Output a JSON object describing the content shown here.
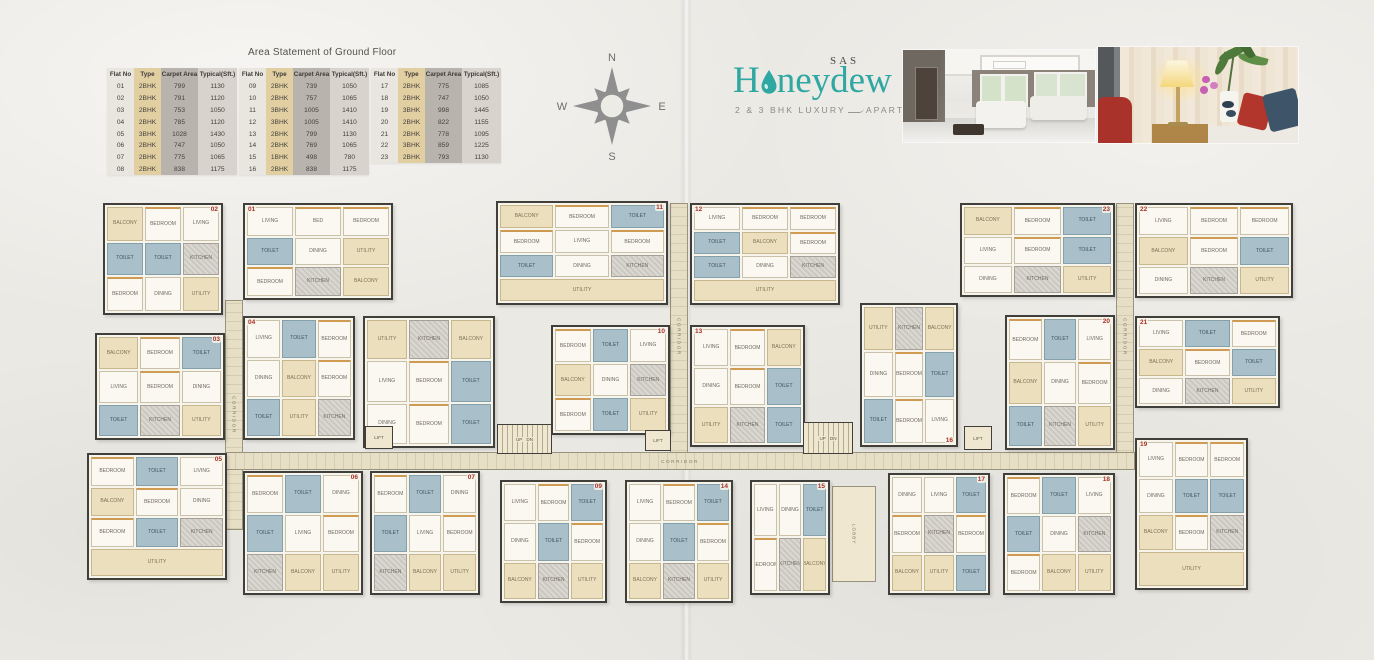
{
  "area_statement": {
    "title": "Area Statement of Ground Floor",
    "columns": [
      "Flat No",
      "Type",
      "Carpet Area",
      "Typical(Sft.)"
    ],
    "top": 68,
    "tables": [
      {
        "x": 107,
        "rows": [
          [
            "01",
            "2BHK",
            "799",
            "1130"
          ],
          [
            "02",
            "2BHK",
            "791",
            "1120"
          ],
          [
            "03",
            "2BHK",
            "753",
            "1050"
          ],
          [
            "04",
            "2BHK",
            "785",
            "1120"
          ],
          [
            "05",
            "3BHK",
            "1028",
            "1430"
          ],
          [
            "06",
            "2BHK",
            "747",
            "1050"
          ],
          [
            "07",
            "2BHK",
            "775",
            "1065"
          ],
          [
            "08",
            "2BHK",
            "838",
            "1175"
          ]
        ]
      },
      {
        "x": 239,
        "rows": [
          [
            "09",
            "2BHK",
            "739",
            "1050"
          ],
          [
            "10",
            "2BHK",
            "757",
            "1065"
          ],
          [
            "11",
            "3BHK",
            "1005",
            "1410"
          ],
          [
            "12",
            "3BHK",
            "1005",
            "1410"
          ],
          [
            "13",
            "2BHK",
            "799",
            "1130"
          ],
          [
            "14",
            "2BHK",
            "769",
            "1065"
          ],
          [
            "15",
            "1BHK",
            "498",
            "780"
          ],
          [
            "16",
            "2BHK",
            "838",
            "1175"
          ]
        ]
      },
      {
        "x": 371,
        "rows": [
          [
            "17",
            "2BHK",
            "775",
            "1085"
          ],
          [
            "18",
            "2BHK",
            "747",
            "1050"
          ],
          [
            "19",
            "3BHK",
            "998",
            "1445"
          ],
          [
            "20",
            "2BHK",
            "822",
            "1155"
          ],
          [
            "21",
            "2BHK",
            "778",
            "1095"
          ],
          [
            "22",
            "3BHK",
            "859",
            "1225"
          ],
          [
            "23",
            "2BHK",
            "793",
            "1130"
          ]
        ]
      }
    ]
  },
  "compass": {
    "n": "N",
    "s": "S",
    "e": "E",
    "w": "W"
  },
  "logo": {
    "pre": "SAS",
    "word_start": "H",
    "word_end": "neydew",
    "tagline_left": "2 & 3 BHK LUXURY",
    "tagline_right": "APARTMENTS"
  },
  "photos": {
    "left": "living-room-interior",
    "right": "lamp-and-cushions-decor"
  },
  "plan": {
    "corridor_label": "CORRIDOR",
    "lift_label": "LIFT",
    "lobby_label": "LOBBY",
    "up_label": "UP",
    "dn_label": "DN",
    "units": [
      {
        "no": "02",
        "x": 103,
        "y": 203,
        "w": 120,
        "h": 112,
        "tag": "tr",
        "rooms": [
          "BALCONY",
          "BEDROOM",
          "LIVING",
          "TOILET",
          "TOILET",
          "KITCHEN",
          "BEDROOM",
          "DINING",
          "UTILITY"
        ]
      },
      {
        "no": "01",
        "x": 243,
        "y": 203,
        "w": 150,
        "h": 97,
        "tag": "tl",
        "rooms": [
          "LIVING",
          "BED",
          "BEDROOM",
          "TOILET",
          "DINING",
          "UTILITY",
          "BEDROOM",
          "KITCHEN",
          "BALCONY"
        ]
      },
      {
        "no": "11",
        "x": 496,
        "y": 201,
        "w": 172,
        "h": 104,
        "tag": "tr",
        "rooms": [
          "BALCONY",
          "BEDROOM",
          "TOILET",
          "BEDROOM",
          "LIVING",
          "BEDROOM",
          "TOILET",
          "DINING",
          "KITCHEN",
          "UTILITY"
        ]
      },
      {
        "no": "12",
        "x": 690,
        "y": 203,
        "w": 150,
        "h": 102,
        "tag": "tl",
        "rooms": [
          "LIVING",
          "BEDROOM",
          "BEDROOM",
          "TOILET",
          "BALCONY",
          "BEDROOM",
          "TOILET",
          "DINING",
          "KITCHEN",
          "UTILITY"
        ]
      },
      {
        "no": "23",
        "x": 960,
        "y": 203,
        "w": 155,
        "h": 94,
        "tag": "tr",
        "rooms": [
          "BALCONY",
          "BEDROOM",
          "TOILET",
          "LIVING",
          "BEDROOM",
          "TOILET",
          "DINING",
          "KITCHEN",
          "UTILITY"
        ]
      },
      {
        "no": "22",
        "x": 1135,
        "y": 203,
        "w": 158,
        "h": 95,
        "tag": "tl",
        "rooms": [
          "LIVING",
          "BEDROOM",
          "BEDROOM",
          "BALCONY",
          "BEDROOM",
          "TOILET",
          "DINING",
          "KITCHEN",
          "UTILITY"
        ]
      },
      {
        "no": "03",
        "x": 95,
        "y": 333,
        "w": 130,
        "h": 107,
        "tag": "tr",
        "rooms": [
          "BALCONY",
          "BEDROOM",
          "TOILET",
          "LIVING",
          "BEDROOM",
          "DINING",
          "TOILET",
          "KITCHEN",
          "UTILITY"
        ]
      },
      {
        "no": "04",
        "x": 243,
        "y": 316,
        "w": 112,
        "h": 124,
        "tag": "tl",
        "rooms": [
          "LIVING",
          "TOILET",
          "BEDROOM",
          "DINING",
          "BALCONY",
          "BEDROOM",
          "TOILET",
          "UTILITY",
          "KITCHEN"
        ]
      },
      {
        "no": "08",
        "x": 363,
        "y": 316,
        "w": 132,
        "h": 132,
        "tag": "bl",
        "rooms": [
          "UTILITY",
          "KITCHEN",
          "BALCONY",
          "LIVING",
          "BEDROOM",
          "TOILET",
          "DINING",
          "BEDROOM",
          "TOILET"
        ]
      },
      {
        "no": "10",
        "x": 551,
        "y": 325,
        "w": 119,
        "h": 110,
        "tag": "tr",
        "rooms": [
          "BEDROOM",
          "TOILET",
          "LIVING",
          "BALCONY",
          "DINING",
          "KITCHEN",
          "BEDROOM",
          "TOILET",
          "UTILITY"
        ]
      },
      {
        "no": "13",
        "x": 690,
        "y": 325,
        "w": 115,
        "h": 122,
        "tag": "tl",
        "rooms": [
          "LIVING",
          "BEDROOM",
          "BALCONY",
          "DINING",
          "BEDROOM",
          "TOILET",
          "UTILITY",
          "KITCHEN",
          "TOILET"
        ]
      },
      {
        "no": "16",
        "x": 860,
        "y": 303,
        "w": 98,
        "h": 144,
        "tag": "br",
        "rooms": [
          "UTILITY",
          "KITCHEN",
          "BALCONY",
          "DINING",
          "BEDROOM",
          "TOILET",
          "TOILET",
          "BEDROOM",
          "LIVING"
        ]
      },
      {
        "no": "20",
        "x": 1005,
        "y": 315,
        "w": 110,
        "h": 135,
        "tag": "tr",
        "rooms": [
          "BEDROOM",
          "TOILET",
          "LIVING",
          "BALCONY",
          "DINING",
          "BEDROOM",
          "TOILET",
          "KITCHEN",
          "UTILITY"
        ]
      },
      {
        "no": "21",
        "x": 1135,
        "y": 316,
        "w": 145,
        "h": 92,
        "tag": "tl",
        "rooms": [
          "LIVING",
          "TOILET",
          "BEDROOM",
          "BALCONY",
          "BEDROOM",
          "TOILET",
          "DINING",
          "KITCHEN",
          "UTILITY"
        ]
      },
      {
        "no": "19",
        "x": 1135,
        "y": 438,
        "w": 113,
        "h": 152,
        "tag": "tl",
        "rooms": [
          "LIVING",
          "BEDROOM",
          "BEDROOM",
          "DINING",
          "TOILET",
          "TOILET",
          "BALCONY",
          "BEDROOM",
          "KITCHEN",
          "UTILITY"
        ]
      },
      {
        "no": "05",
        "x": 87,
        "y": 453,
        "w": 140,
        "h": 127,
        "tag": "tr",
        "rooms": [
          "BEDROOM",
          "TOILET",
          "LIVING",
          "BALCONY",
          "BEDROOM",
          "DINING",
          "BEDROOM",
          "TOILET",
          "KITCHEN",
          "UTILITY"
        ]
      },
      {
        "no": "06",
        "x": 243,
        "y": 471,
        "w": 120,
        "h": 124,
        "tag": "tr",
        "rooms": [
          "BEDROOM",
          "TOILET",
          "DINING",
          "TOILET",
          "LIVING",
          "BEDROOM",
          "KITCHEN",
          "BALCONY",
          "UTILITY"
        ]
      },
      {
        "no": "07",
        "x": 370,
        "y": 471,
        "w": 110,
        "h": 124,
        "tag": "tr",
        "rooms": [
          "BEDROOM",
          "TOILET",
          "DINING",
          "TOILET",
          "LIVING",
          "BEDROOM",
          "KITCHEN",
          "BALCONY",
          "UTILITY"
        ]
      },
      {
        "no": "09",
        "x": 500,
        "y": 480,
        "w": 107,
        "h": 123,
        "tag": "tr",
        "rooms": [
          "LIVING",
          "BEDROOM",
          "TOILET",
          "DINING",
          "TOILET",
          "BEDROOM",
          "BALCONY",
          "KITCHEN",
          "UTILITY"
        ]
      },
      {
        "no": "14",
        "x": 625,
        "y": 480,
        "w": 108,
        "h": 123,
        "tag": "tr",
        "rooms": [
          "LIVING",
          "BEDROOM",
          "TOILET",
          "DINING",
          "TOILET",
          "BEDROOM",
          "BALCONY",
          "KITCHEN",
          "UTILITY"
        ]
      },
      {
        "no": "15",
        "x": 750,
        "y": 480,
        "w": 80,
        "h": 115,
        "tag": "tr",
        "rooms": [
          "LIVING",
          "DINING",
          "TOILET",
          "BEDROOM",
          "KITCHEN",
          "BALCONY"
        ]
      },
      {
        "no": "17",
        "x": 888,
        "y": 473,
        "w": 102,
        "h": 122,
        "tag": "tr",
        "rooms": [
          "DINING",
          "LIVING",
          "TOILET",
          "BEDROOM",
          "KITCHEN",
          "BEDROOM",
          "BALCONY",
          "UTILITY",
          "TOILET"
        ]
      },
      {
        "no": "18",
        "x": 1003,
        "y": 473,
        "w": 112,
        "h": 122,
        "tag": "tr",
        "rooms": [
          "BEDROOM",
          "TOILET",
          "LIVING",
          "TOILET",
          "DINING",
          "KITCHEN",
          "BEDROOM",
          "BALCONY",
          "UTILITY"
        ]
      }
    ]
  },
  "colors": {
    "brand_teal": "#2fa7a2",
    "unit_number_red": "#a93226",
    "wall_dark": "#413f3a",
    "toilet_blue": "#a9bfc9",
    "balcony_tan": "#ecdfbe",
    "corridor_beige": "#e7dfc5",
    "accent_orange": "#cf9a52",
    "paper": "#ebe9e4"
  }
}
